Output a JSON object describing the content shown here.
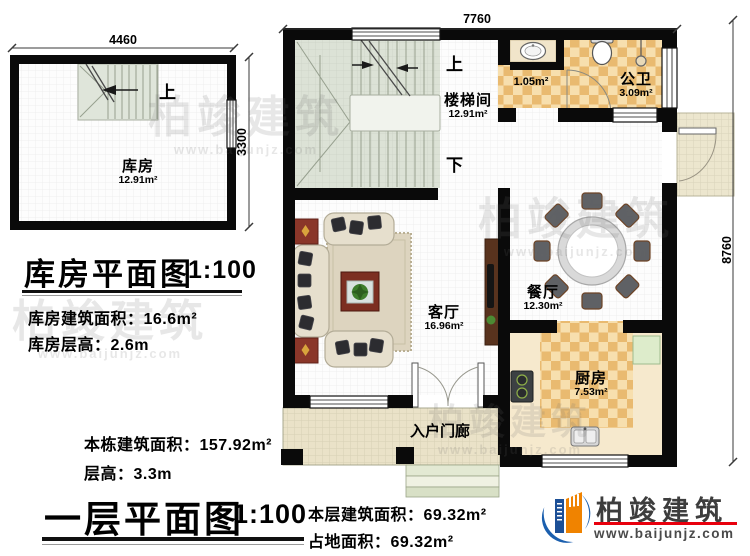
{
  "brand": {
    "name": "柏竣建筑",
    "url": "www.baijunjz.com"
  },
  "storage_plan": {
    "title": "库房平面图",
    "scale": "1:100",
    "up_label": "上",
    "dims": {
      "w": "4460",
      "h": "3300"
    },
    "room": {
      "name": "库房",
      "area": "12.91m²"
    },
    "info": [
      {
        "text": "库房建筑面积：16.6m²"
      },
      {
        "text": "库房层高：2.6m"
      }
    ]
  },
  "floor_plan": {
    "title": "一层平面图",
    "scale": "1:100",
    "dims": {
      "w": "7760",
      "h": "8760"
    },
    "labels": {
      "up": "上",
      "down": "下"
    },
    "rooms": {
      "stairwell": {
        "name": "楼梯间",
        "area": "12.91m²"
      },
      "public_bath": {
        "name": "公卫",
        "area": "3.09m²"
      },
      "bath_lobby": {
        "area": "1.05m²"
      },
      "dining": {
        "name": "餐厅",
        "area": "12.30m²"
      },
      "living": {
        "name": "客厅",
        "area": "16.96m²"
      },
      "kitchen": {
        "name": "厨房",
        "area": "7.53m²"
      },
      "entry_porch": {
        "name": "入户门廊"
      }
    },
    "info_left": [
      {
        "text": "本栋建筑面积：157.92m²"
      },
      {
        "text": "层高：3.3m"
      }
    ],
    "info_right": [
      {
        "text": "本层建筑面积：69.32m²"
      },
      {
        "text": "占地面积：69.32m²"
      }
    ]
  }
}
